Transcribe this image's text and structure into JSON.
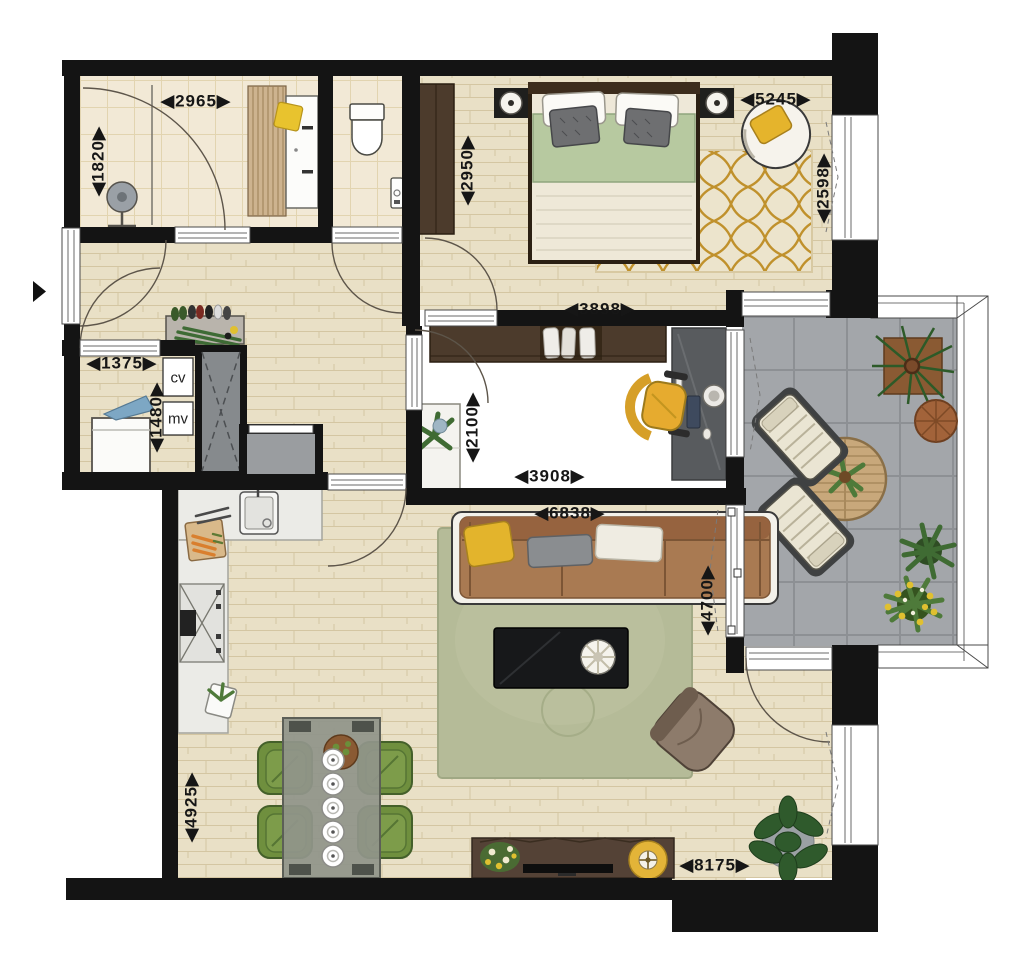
{
  "plan": {
    "type": "apartment-floor-plan",
    "labels": {
      "bathroom_width": "◀2965▶",
      "bathroom_depth": "◀1820▶",
      "bedroom_depth_left": "◀2950▶",
      "bedroom_width_top": "◀5245▶",
      "bedroom_depth_right": "◀2598▶",
      "bedroom_width_bottom": "◀3898▶",
      "entry_width": "◀1375▶",
      "utility_depth": "◀1480▶",
      "utility_cv": "cv",
      "utility_mv": "mv",
      "office_depth": "◀2100▶",
      "office_width": "◀3908▶",
      "living_width": "◀6838▶",
      "living_depth": "◀4700▶",
      "dining_depth": "◀4925▶",
      "total_width_bottom": "◀8175▶"
    },
    "colors": {
      "wall": "#141414",
      "wood_floor": "#e9e0c6",
      "bath_tile": "#f2e9d6",
      "balcony_tile": "#a3a6aa",
      "living_rug": "#b5bb98",
      "bedroom_rug_gold": "#c0912c",
      "sofa_brown": "#a97a52",
      "bed_blanket_green": "#b7c9a0",
      "accent_yellow": "#e6b02f",
      "dining_chair_green": "#6f8f3e",
      "desk_gray": "#55585a",
      "wardrobe_brown": "#4c3b2c"
    }
  }
}
